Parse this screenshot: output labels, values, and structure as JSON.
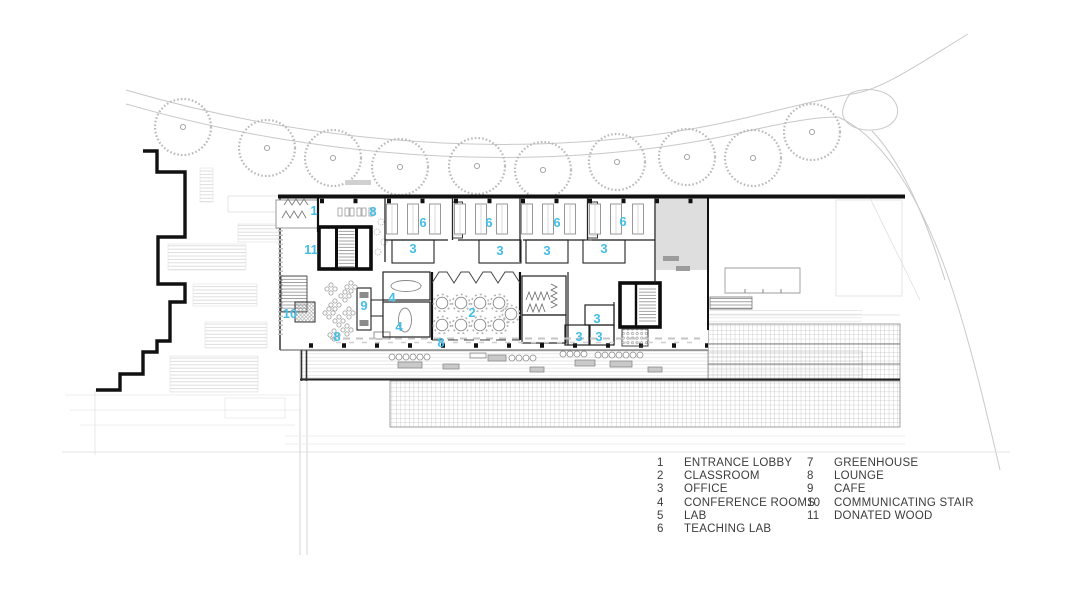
{
  "drawing": {
    "type": "architectural ground floor site plan",
    "colors": {
      "accent_blue": "#45BDE6",
      "wall_ink": "#1A1A1A",
      "line_gray": "#C6C6C6",
      "legend_text": "#3C3C3C"
    }
  },
  "legend": {
    "columns": [
      {
        "items": [
          {
            "num": "1",
            "label": "ENTRANCE LOBBY"
          },
          {
            "num": "2",
            "label": "CLASSROOM"
          },
          {
            "num": "3",
            "label": "OFFICE"
          },
          {
            "num": "4",
            "label": "CONFERENCE ROOMS"
          },
          {
            "num": "5",
            "label": "LAB"
          },
          {
            "num": "6",
            "label": "TEACHING LAB"
          }
        ]
      },
      {
        "items": [
          {
            "num": "7",
            "label": "GREENHOUSE"
          },
          {
            "num": "8",
            "label": "LOUNGE"
          },
          {
            "num": "9",
            "label": "CAFE"
          },
          {
            "num": "10",
            "label": "COMMUNICATING STAIR"
          },
          {
            "num": "11",
            "label": "DONATED WOOD"
          }
        ]
      }
    ]
  },
  "plan_labels": [
    {
      "text": "1",
      "room": "ENTRANCE LOBBY"
    },
    {
      "text": "8",
      "room": "LOUNGE"
    },
    {
      "text": "6",
      "room": "TEACHING LAB"
    },
    {
      "text": "6",
      "room": "TEACHING LAB"
    },
    {
      "text": "6",
      "room": "TEACHING LAB"
    },
    {
      "text": "6",
      "room": "TEACHING LAB"
    },
    {
      "text": "3",
      "room": "OFFICE"
    },
    {
      "text": "3",
      "room": "OFFICE"
    },
    {
      "text": "3",
      "room": "OFFICE"
    },
    {
      "text": "3",
      "room": "OFFICE"
    },
    {
      "text": "11",
      "room": "DONATED WOOD"
    },
    {
      "text": "10",
      "room": "COMMUNICATING STAIR"
    },
    {
      "text": "9",
      "room": "CAFE"
    },
    {
      "text": "4",
      "room": "CONFERENCE ROOMS"
    },
    {
      "text": "4",
      "room": "CONFERENCE ROOMS"
    },
    {
      "text": "2",
      "room": "CLASSROOM"
    },
    {
      "text": "8",
      "room": "LOUNGE"
    },
    {
      "text": "8",
      "room": "LOUNGE"
    },
    {
      "text": "3",
      "room": "OFFICE"
    },
    {
      "text": "3",
      "room": "OFFICE"
    },
    {
      "text": "3",
      "room": "OFFICE"
    }
  ]
}
